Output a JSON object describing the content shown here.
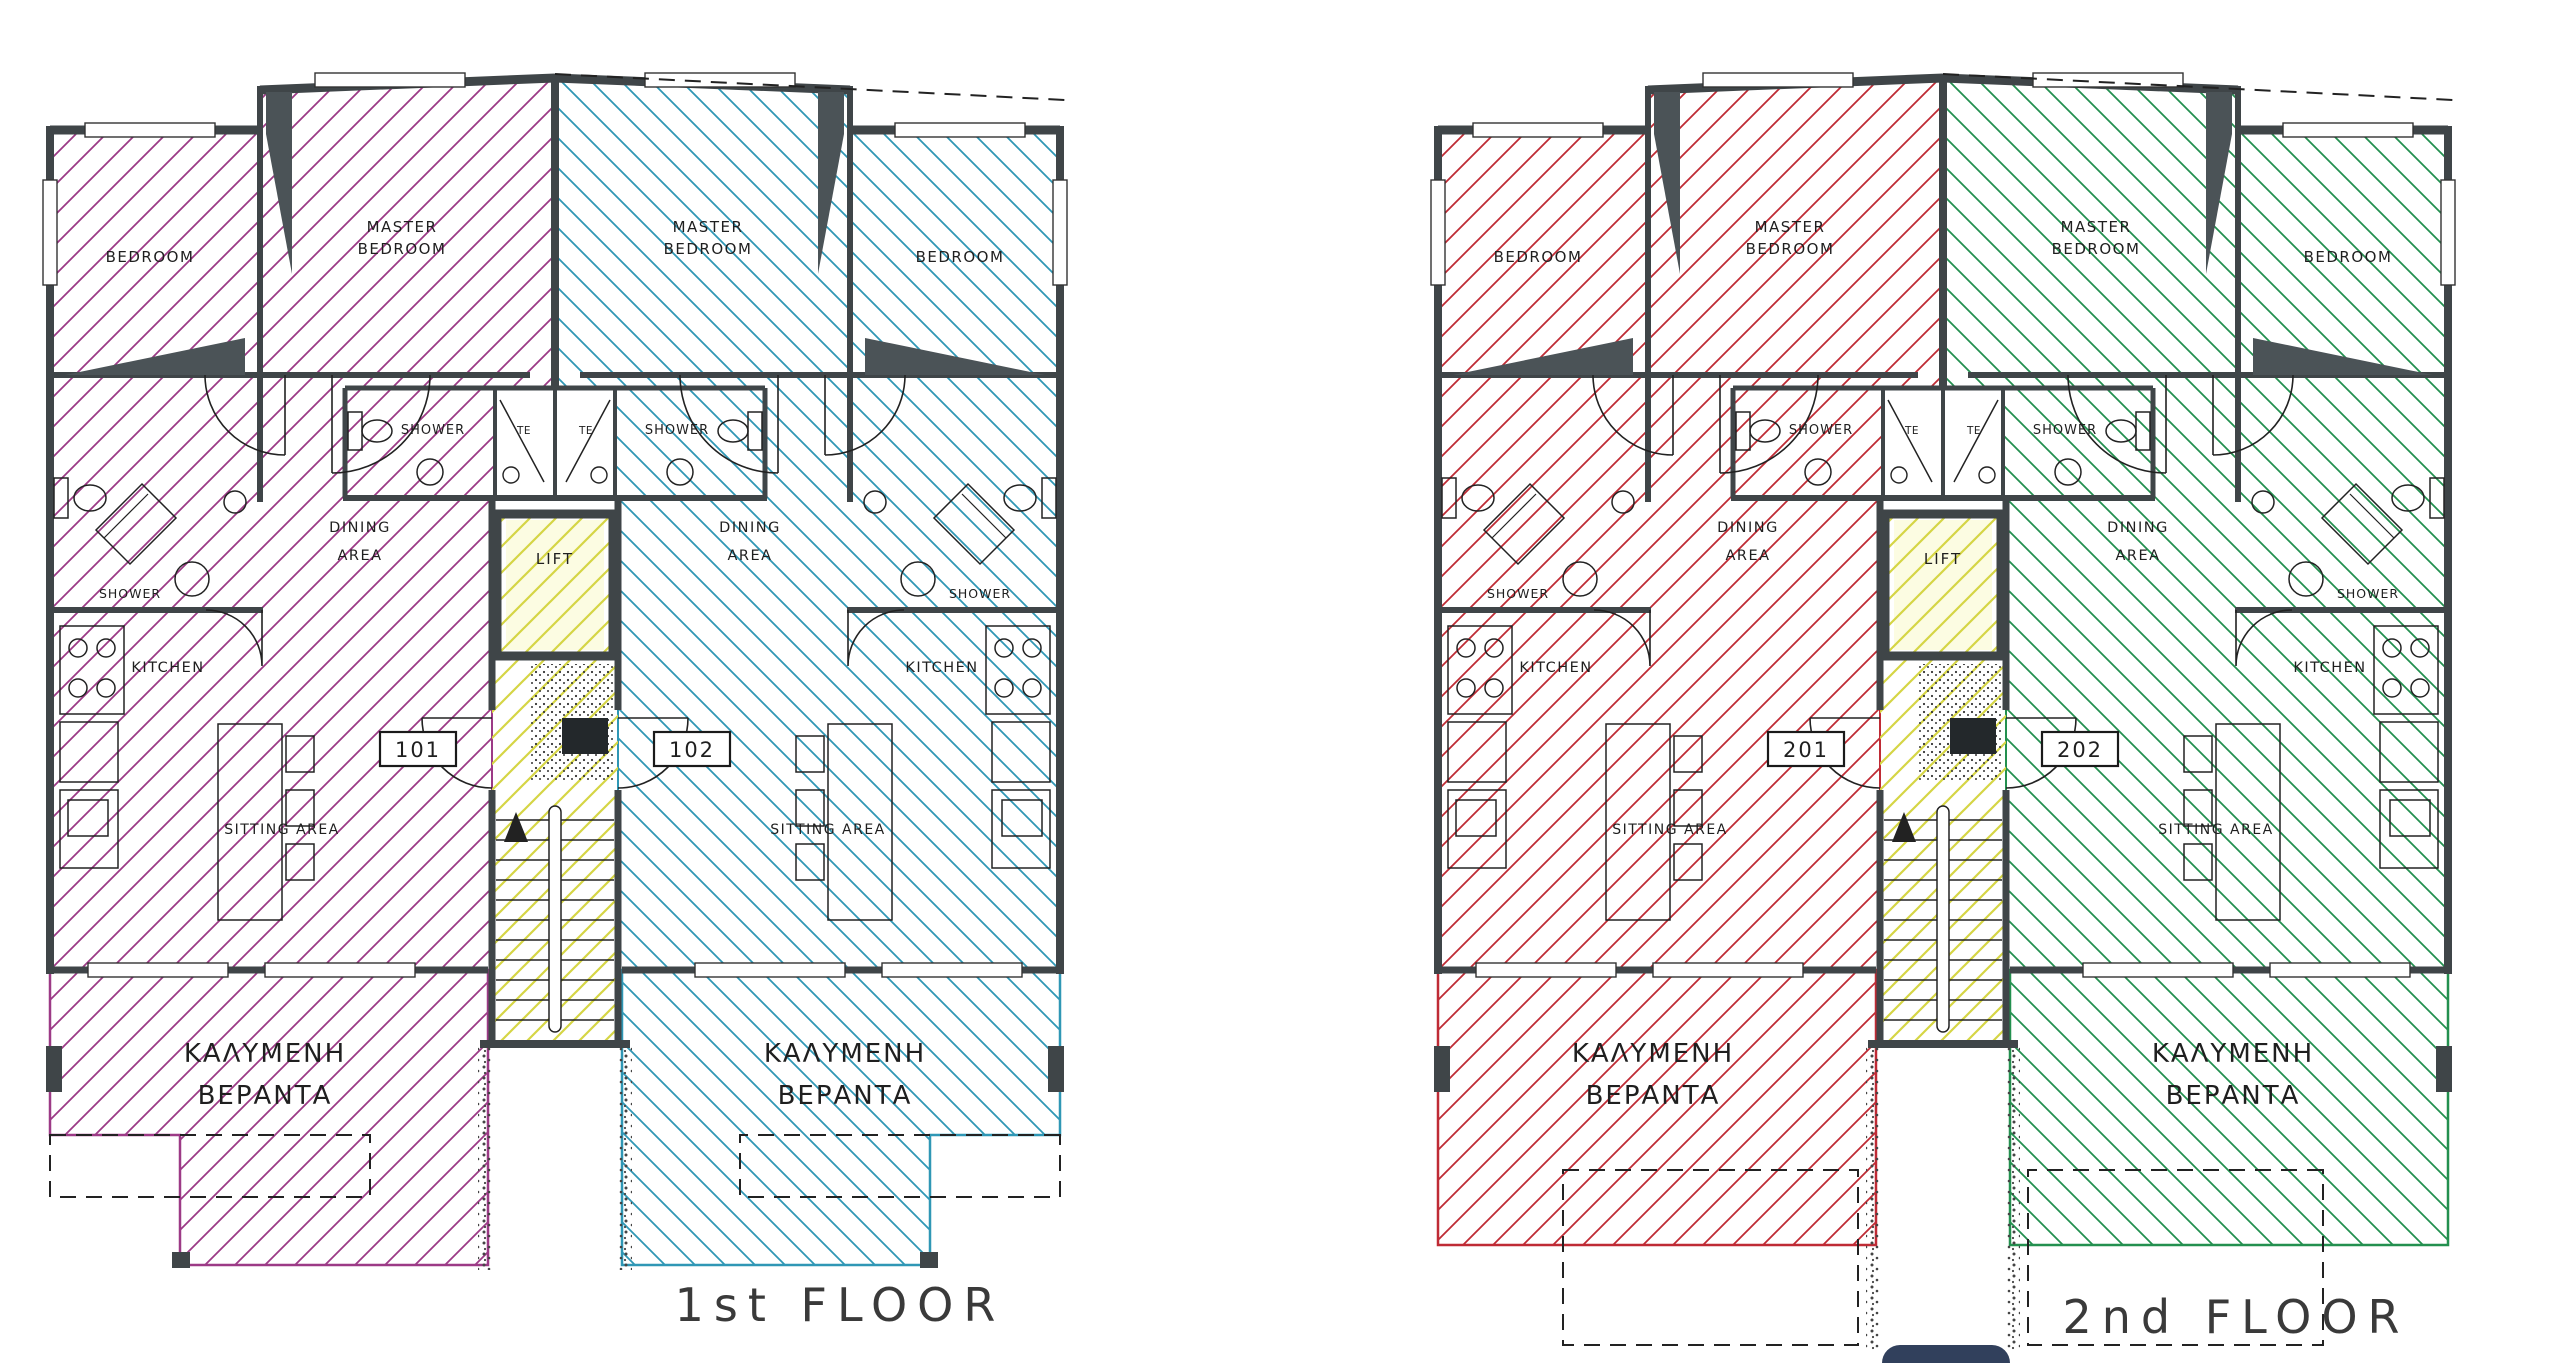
{
  "drawing_title": "Apartment building floor plans",
  "colors": {
    "background": "#ffffff",
    "wall": "#3f4548",
    "linework": "#222222",
    "core_hatch": "#d5d545",
    "lift_fill": "#fcfce2",
    "unit_101_hatch": "#9c3a86",
    "unit_102_hatch": "#2f97b5",
    "unit_201_hatch": "#bf2b35",
    "unit_202_hatch": "#23904f",
    "floor_label_text": "#3a3a3a",
    "logo": "#31405c"
  },
  "room_labels": {
    "bedroom": "BEDROOM",
    "master_bedroom_line1": "MASTER",
    "master_bedroom_line2": "BEDROOM",
    "shower": "SHOWER",
    "dining_line1": "DINING",
    "dining_line2": "AREA",
    "kitchen": "KITCHEN",
    "sitting_area": "SITTING  AREA",
    "veranda_line1": "ΚΑΛΥΜΕΝΗ",
    "veranda_line2": "ΒΕΡΑΝΤΑ",
    "lift": "LIFT",
    "te_closet": "TE"
  },
  "floor_plans": [
    {
      "id": "first-floor",
      "floor_label": "1st  FLOOR",
      "left_unit": {
        "number": "101",
        "color_key": "unit_101_hatch"
      },
      "right_unit": {
        "number": "102",
        "color_key": "unit_102_hatch"
      },
      "veranda_style": "notched"
    },
    {
      "id": "second-floor",
      "floor_label": "2nd  FLOOR",
      "left_unit": {
        "number": "201",
        "color_key": "unit_201_hatch"
      },
      "right_unit": {
        "number": "202",
        "color_key": "unit_202_hatch"
      },
      "veranda_style": "dashed-below"
    }
  ]
}
